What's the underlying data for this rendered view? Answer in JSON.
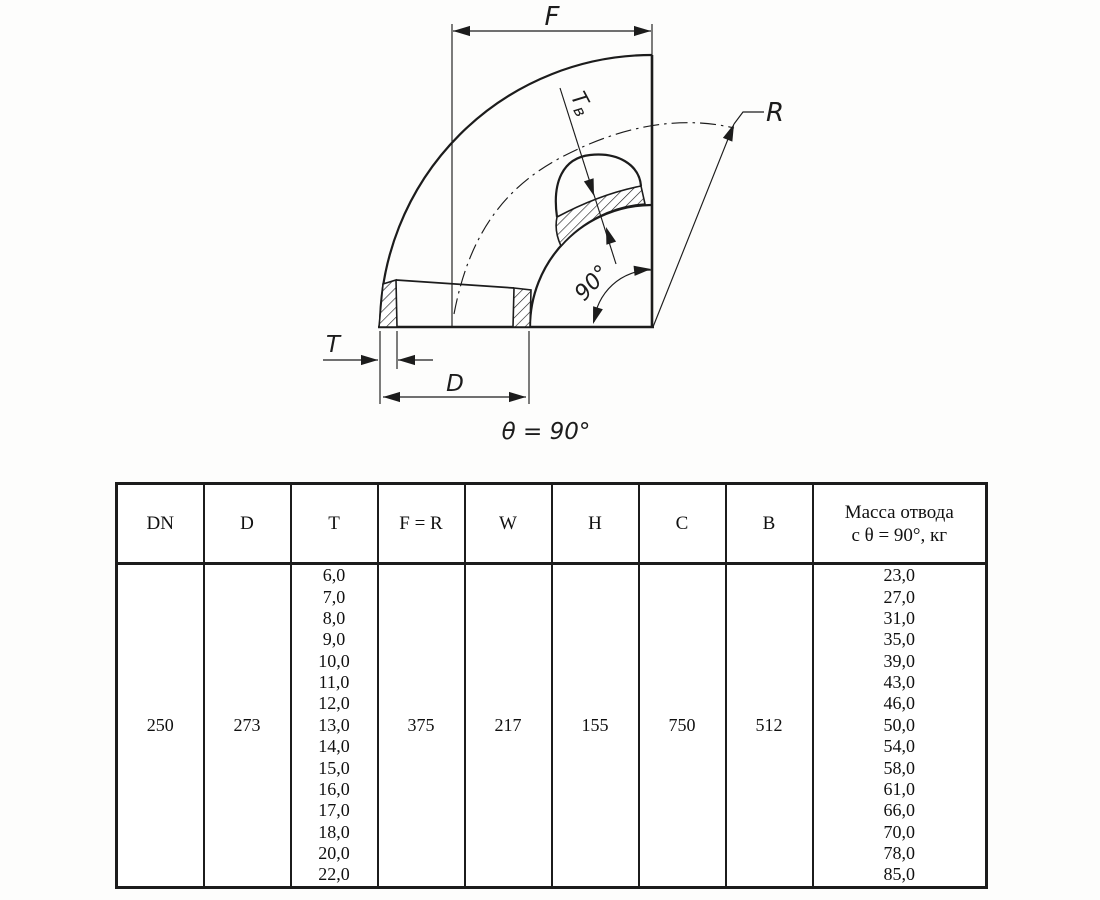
{
  "drawing": {
    "labels": {
      "f": "F",
      "r": "R",
      "tv_main": "T",
      "tv_sub": "в",
      "t": "T",
      "d": "D",
      "angle": "90°",
      "caption": "θ = 90°"
    }
  },
  "table": {
    "headers": [
      "DN",
      "D",
      "T",
      "F = R",
      "W",
      "H",
      "C",
      "B"
    ],
    "mass_header": [
      "Масса отвода",
      "с θ = 90°, кг"
    ],
    "row": {
      "dn": "250",
      "d": "273",
      "t_values": [
        "6,0",
        "7,0",
        "8,0",
        "9,0",
        "10,0",
        "11,0",
        "12,0",
        "13,0",
        "14,0",
        "15,0",
        "16,0",
        "17,0",
        "18,0",
        "20,0",
        "22,0"
      ],
      "f_r": "375",
      "w": "217",
      "h": "155",
      "c": "750",
      "b": "512",
      "mass_values": [
        "23,0",
        "27,0",
        "31,0",
        "35,0",
        "39,0",
        "43,0",
        "46,0",
        "50,0",
        "54,0",
        "58,0",
        "61,0",
        "66,0",
        "70,0",
        "78,0",
        "85,0"
      ]
    }
  },
  "colors": {
    "line": "#1c1c1c",
    "background": "#fdfdfc",
    "table_text": "#111111"
  }
}
